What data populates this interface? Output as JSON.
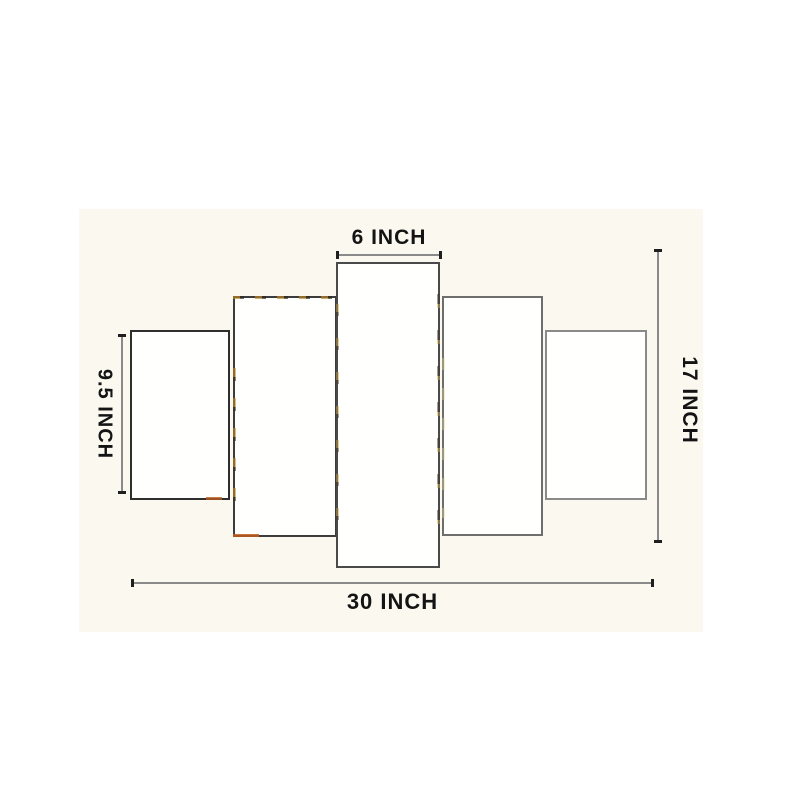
{
  "diagram": {
    "type": "product-dimension-diagram",
    "panel_count": 5,
    "labels": {
      "top": "6 INCH",
      "left": "9.5 INCH",
      "right": "17 INCH",
      "bottom": "30 INCH"
    },
    "measurements": {
      "center_panel_width_in": 6,
      "outer_panel_height_in": 9.5,
      "total_height_in": 17,
      "total_width_in": 30,
      "unit": "INCH"
    },
    "colors": {
      "page_background": "#ffffff",
      "photo_background": "#fbf8ef",
      "panel_fill": "#fffffe",
      "panel_border": "#3c3c3c",
      "dimension_line": "#8a8a8a",
      "label_text": "#141414",
      "edge_speckle_gold": "#c48c2c",
      "edge_speckle_orange": "#b85c1e"
    }
  }
}
